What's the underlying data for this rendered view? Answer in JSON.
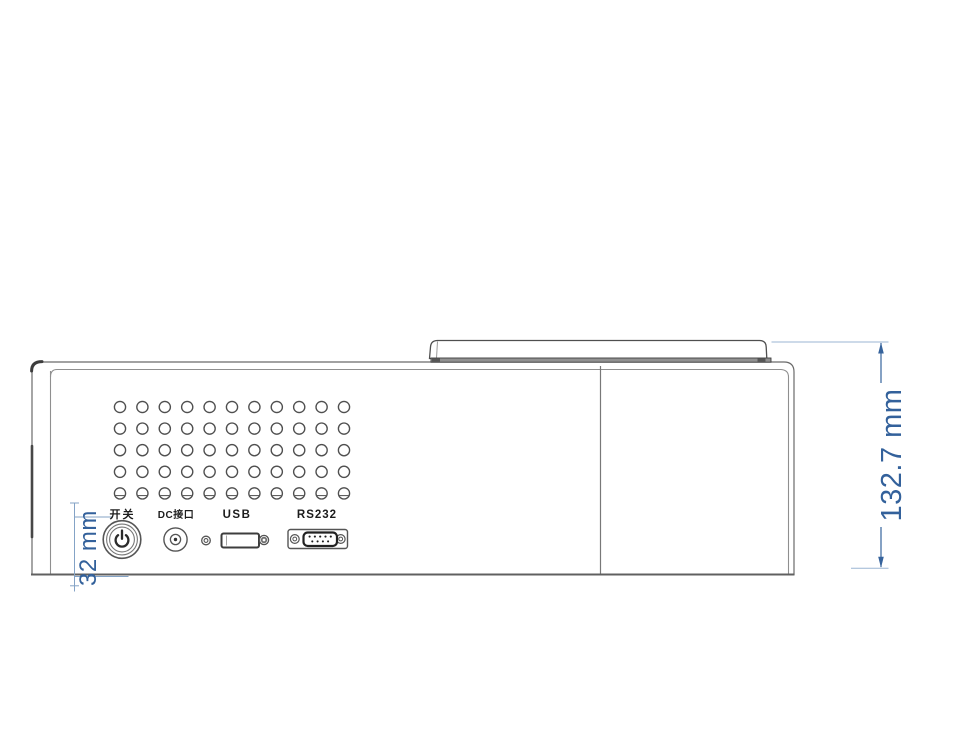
{
  "diagram": {
    "view": "device rear panel line drawing",
    "panel": {
      "ports": [
        {
          "name": "power-switch",
          "label": "开关"
        },
        {
          "name": "dc-input",
          "label": "DC接口"
        },
        {
          "name": "usb",
          "label": "USB"
        },
        {
          "name": "rs232",
          "label": "RS232"
        }
      ],
      "vent_grid": {
        "rows": 5,
        "cols": 11
      },
      "rs232_pins": {
        "top": 5,
        "bottom": 4
      }
    },
    "dimensions": {
      "overall_height": {
        "value": "132.7",
        "unit": "mm",
        "label": "132.7 mm"
      },
      "port_section_height": {
        "value": "32",
        "unit": "mm",
        "label": "32 mm"
      }
    },
    "colors": {
      "dimension_text": "#33619b",
      "dimension_line": "#8aa9cb",
      "outline": "#5a5a5a",
      "background": "#ffffff"
    }
  }
}
